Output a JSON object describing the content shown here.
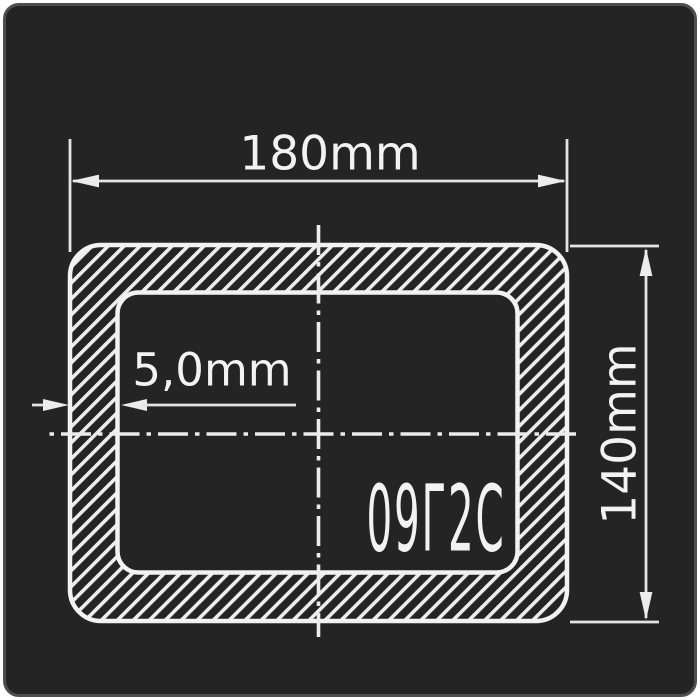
{
  "diagram": {
    "labels": {
      "outer_width": "180mm",
      "outer_height": "140mm",
      "wall_thickness": "5,0mm",
      "steel_grade": "09Г2С"
    },
    "colors": {
      "page": "#ffffff",
      "background": "#242424",
      "panel_border": "#4e4e4e",
      "outline": "#f2f2f2",
      "dimension_lines": "#e4e4e4",
      "text": "#f2f2f2"
    }
  }
}
